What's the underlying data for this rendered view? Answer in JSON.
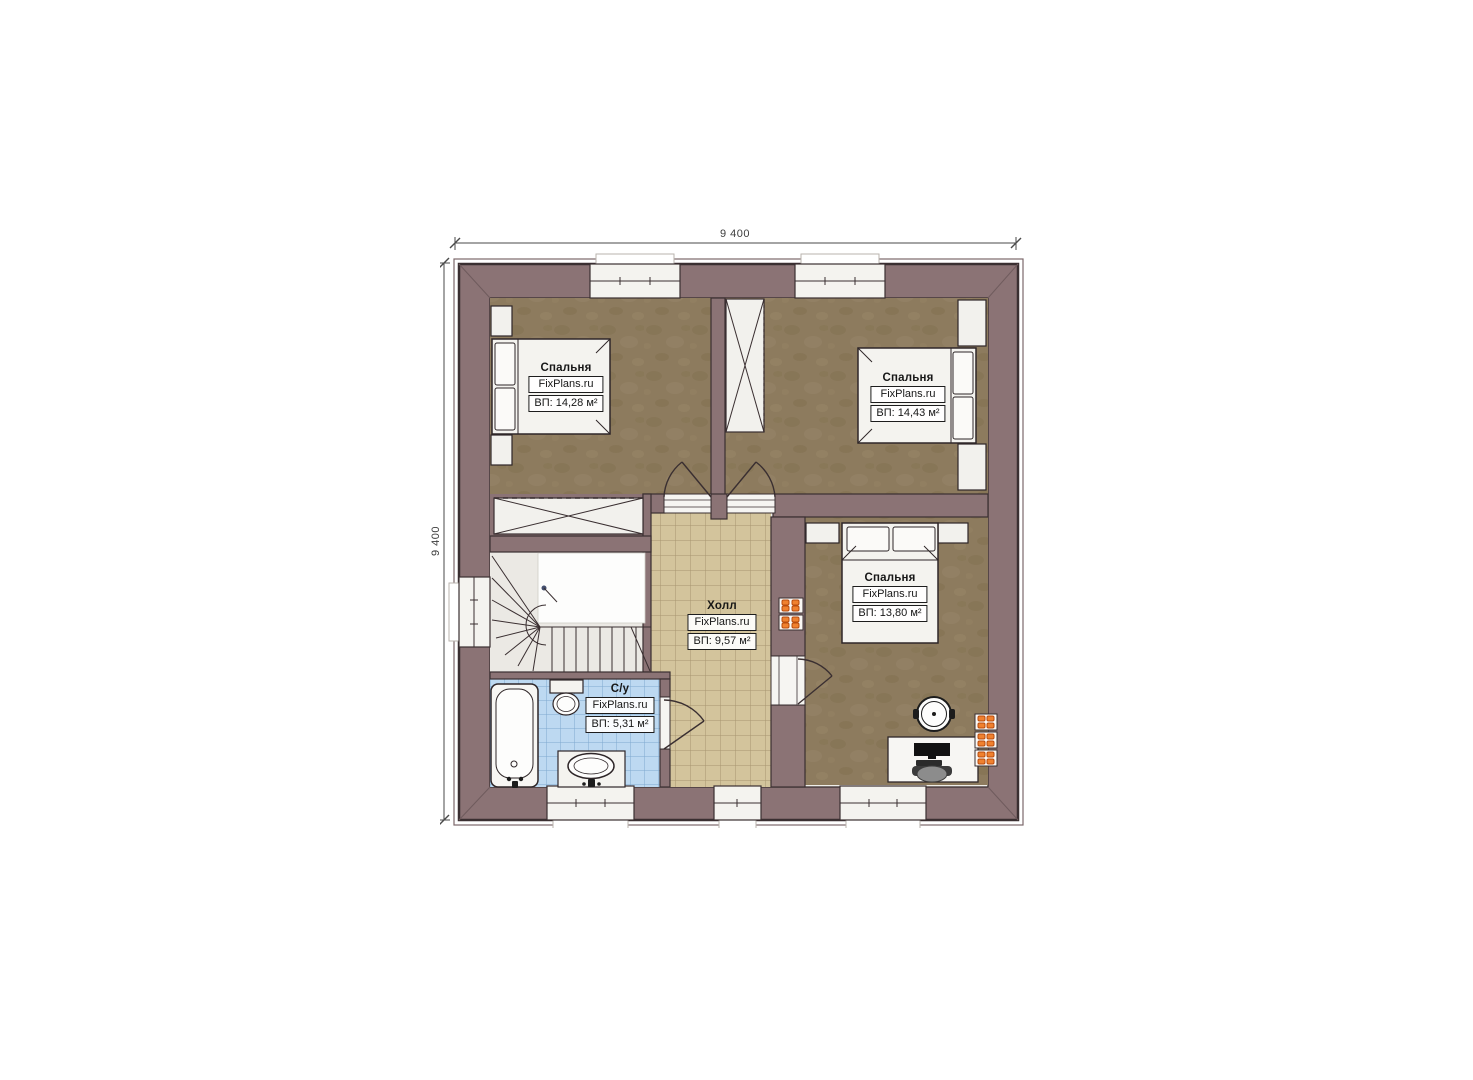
{
  "dimensions": {
    "width_label": "9 400",
    "height_label": "9 400"
  },
  "rooms": {
    "bedroom_top_left": {
      "name": "Спальня",
      "site": "FixPlans.ru",
      "area": "ВП: 14,28 м²"
    },
    "bedroom_top_right": {
      "name": "Спальня",
      "site": "FixPlans.ru",
      "area": "ВП: 14,43 м²"
    },
    "bedroom_bottom_right": {
      "name": "Спальня",
      "site": "FixPlans.ru",
      "area": "ВП: 13,80 м²"
    },
    "hall": {
      "name": "Холл",
      "site": "FixPlans.ru",
      "area": "ВП: 9,57 м²"
    },
    "bathroom": {
      "name": "С/у",
      "site": "FixPlans.ru",
      "area": "ВП: 5,31 м²"
    }
  },
  "colors": {
    "wall": "#8b7375",
    "wall_line": "#3a2f31",
    "bedroom_floor": "#8d7b5e",
    "hall_tile": "#d3c49c",
    "bathroom_tile": "#bdd9f1",
    "fixture_white": "#f4f3ef",
    "radiator_orange": "#f0812f"
  }
}
